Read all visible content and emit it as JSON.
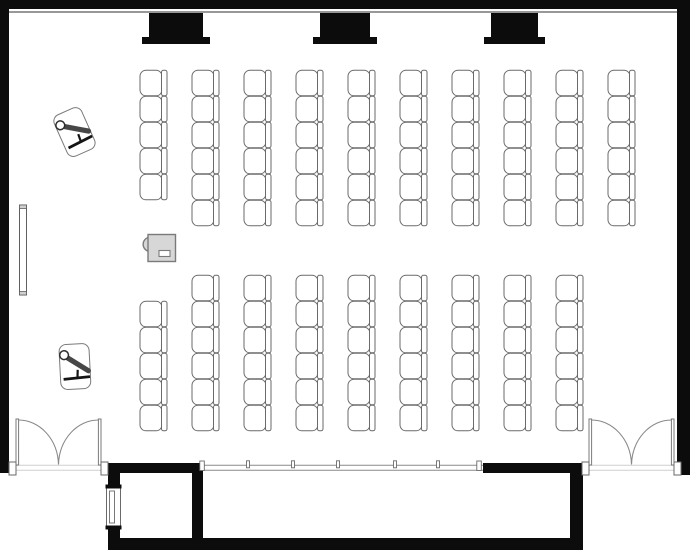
{
  "canvas": {
    "w": 690,
    "h": 550
  },
  "colors": {
    "wall": "#0c0c0c",
    "outline": "#6a6a6a",
    "soft_outline": "#8a8a8a",
    "light_line": "#cfcfcf",
    "fill": "#ffffff",
    "gray_fill": "#d7d7d7",
    "gray_stroke": "#7a7a7a",
    "dark": "#2e2e2e"
  },
  "walls": [
    {
      "id": "outer-wall-top",
      "x": 0,
      "y": 0,
      "w": 690,
      "h": 9
    },
    {
      "id": "outer-wall-left",
      "x": 0,
      "y": 0,
      "w": 9,
      "h": 473
    },
    {
      "id": "outer-wall-right",
      "x": 677,
      "y": 0,
      "w": 13,
      "h": 475
    },
    {
      "id": "bottom-wall-left-solid",
      "x": 108,
      "y": 463,
      "w": 95,
      "h": 10
    },
    {
      "id": "bottom-wall-right-solid",
      "x": 483,
      "y": 463,
      "w": 100,
      "h": 10
    },
    {
      "id": "vestibule-wall-left",
      "x": 108,
      "y": 473,
      "w": 12,
      "h": 77
    },
    {
      "id": "vestibule-wall-right",
      "x": 192,
      "y": 473,
      "w": 11,
      "h": 65
    },
    {
      "id": "corridor-wall-bottom",
      "x": 108,
      "y": 538,
      "w": 475,
      "h": 12
    },
    {
      "id": "corridor-wall-right",
      "x": 570,
      "y": 473,
      "w": 13,
      "h": 77
    }
  ],
  "top_rail": {
    "x1": 9,
    "x2": 677,
    "y": 12
  },
  "screen_style": {
    "y": 13,
    "top_h": 24,
    "base_h": 7,
    "top_inset": 7
  },
  "screens": [
    {
      "base_x": 142,
      "base_w": 68
    },
    {
      "base_x": 313,
      "base_w": 64
    },
    {
      "base_x": 484,
      "base_w": 61
    }
  ],
  "glazing": {
    "x1": 203,
    "x2": 483,
    "y_top": 465.3,
    "y_bot": 470.3,
    "mullions": [
      248,
      293,
      338,
      395,
      438
    ],
    "posts": [
      202,
      479
    ]
  },
  "doors": [
    {
      "id": "double-door-left",
      "hinge_l": 16,
      "hinge_r": 101,
      "sill_y": 465,
      "leaf_top": 419,
      "leaf_w": 2.6
    },
    {
      "id": "double-door-right",
      "hinge_l": 589,
      "hinge_r": 674,
      "sill_y": 465,
      "leaf_top": 419,
      "leaf_w": 2.6
    }
  ],
  "jamb_style": {
    "w": 7,
    "y": 462,
    "h": 13
  },
  "vestibule_window": {
    "x": 105.5,
    "y": 486,
    "w": 16,
    "h": 42
  },
  "whiteboard": {
    "x": 19.5,
    "y": 205,
    "w": 7,
    "h": 90
  },
  "chair_style": {
    "seat_w": 22,
    "seat_h": 25.5,
    "seat_rx": 6,
    "back_w": 5.5,
    "back_rx": 2
  },
  "chair_blocks": [
    {
      "id": "chair-block-front",
      "x0": 140,
      "dx": 52,
      "y0": 70,
      "dy": 26,
      "cols": [
        5,
        6,
        6,
        6,
        6,
        6,
        6,
        6,
        6,
        6
      ],
      "offsets": [
        0,
        0,
        0,
        0,
        0,
        0,
        0,
        0,
        0,
        0
      ]
    },
    {
      "id": "chair-block-rear",
      "x0": 140,
      "dx": 52,
      "y0": 275,
      "dy": 26,
      "cols": [
        5,
        6,
        6,
        6,
        6,
        6,
        6,
        6,
        6
      ],
      "offsets": [
        1,
        0,
        0,
        0,
        0,
        0,
        0,
        0,
        0
      ]
    }
  ],
  "projector": {
    "x": 148,
    "y": 234.5,
    "w": 27.5,
    "h": 27
  },
  "easels": [
    {
      "cx": 76,
      "cy": 133,
      "rot": -27
    },
    {
      "cx": 76,
      "cy": 368,
      "rot": -6
    }
  ]
}
